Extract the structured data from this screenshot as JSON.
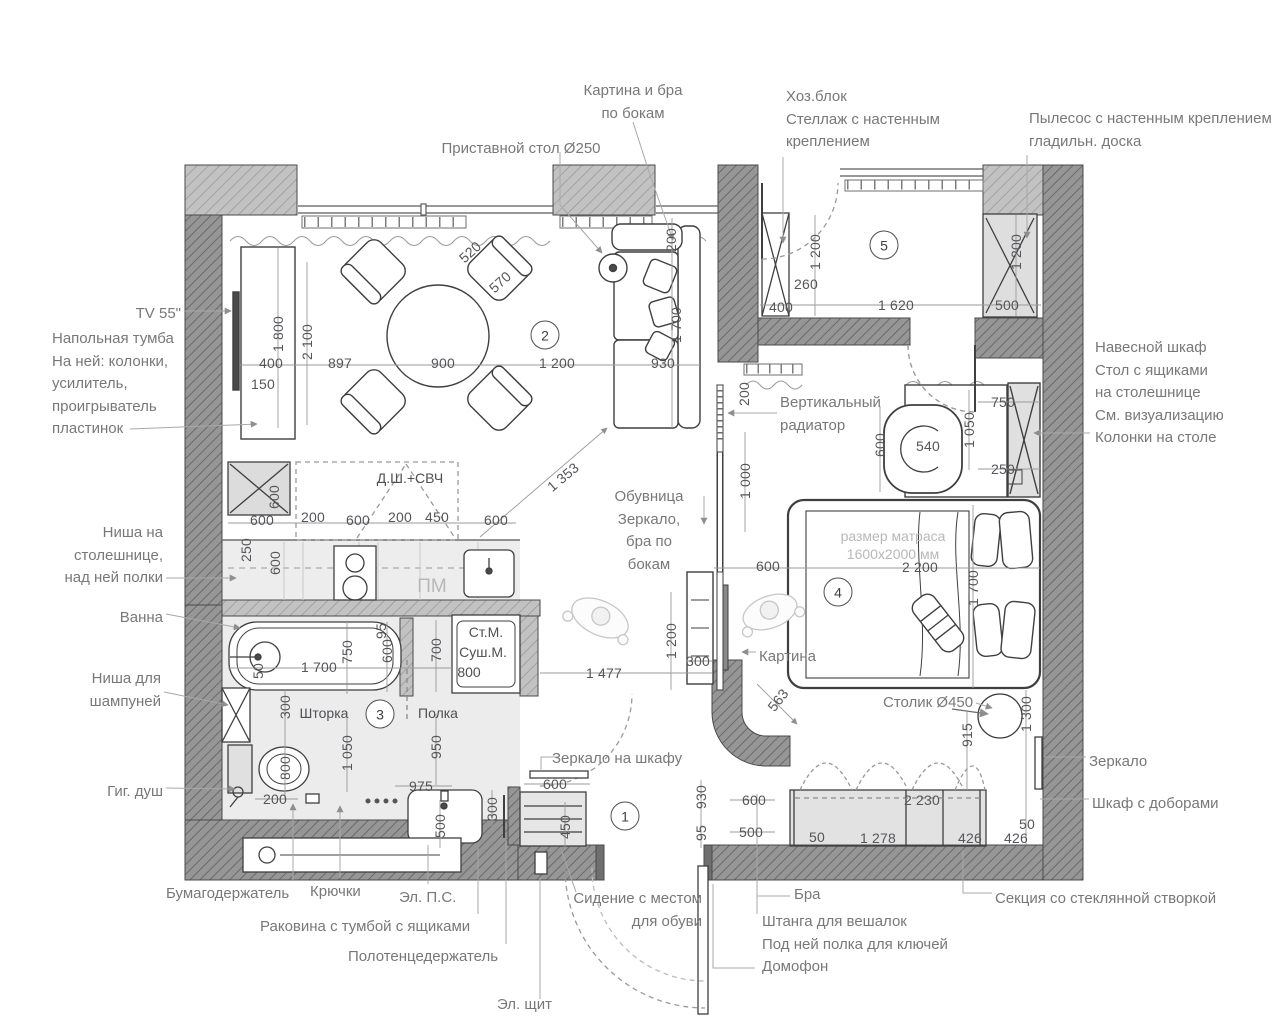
{
  "meta": {
    "doc_type": "apartment interior floor plan",
    "language": "ru"
  },
  "colors": {
    "background": "#ffffff",
    "wall_dark": "#969696",
    "wall_hatch_dark": "#6a6a6a",
    "wall_medium": "#bdbdbd",
    "furniture_line": "#3f3f3f",
    "floor_light": "#ececec",
    "dim_text": "#55555a",
    "annotation_text": "#787878",
    "muted_text": "#b8b8b8"
  },
  "room_markers": [
    {
      "num": "1",
      "x": 625,
      "y": 816
    },
    {
      "num": "2",
      "x": 545,
      "y": 335
    },
    {
      "num": "3",
      "x": 380,
      "y": 714
    },
    {
      "num": "4",
      "x": 838,
      "y": 592
    },
    {
      "num": "5",
      "x": 884,
      "y": 245
    }
  ],
  "annotations": [
    {
      "text": "Картина и бра\nпо бокам",
      "x": 633,
      "y": 80,
      "align": "center"
    },
    {
      "text": "Приставной стол Ø250",
      "x": 521,
      "y": 138,
      "align": "center"
    },
    {
      "text": "Хоз.блок\nСтеллаж с настенным\nкреплением",
      "x": 786,
      "y": 86,
      "align": "left"
    },
    {
      "text": "Пылесос с настенным креплением\nгладильн. доска",
      "x": 1029,
      "y": 108,
      "align": "left"
    },
    {
      "text": "TV 55\"",
      "x": 181,
      "y": 303,
      "align": "right"
    },
    {
      "text": "Напольная тумба\nНа ней: колонки,\nусилитель,\nпроигрыватель\nпластинок",
      "x": 52,
      "y": 328,
      "align": "left"
    },
    {
      "text": "Ниша на\nстолешнице,\nнад ней полки",
      "x": 163,
      "y": 522,
      "align": "right"
    },
    {
      "text": "Ванна",
      "x": 163,
      "y": 607,
      "align": "right"
    },
    {
      "text": "Ниша для\nшампуней",
      "x": 161,
      "y": 668,
      "align": "right"
    },
    {
      "text": "Гиг. душ",
      "x": 163,
      "y": 781,
      "align": "right"
    },
    {
      "text": "Бумагодержатель",
      "x": 166,
      "y": 883,
      "align": "left"
    },
    {
      "text": "Крючки",
      "x": 310,
      "y": 881,
      "align": "left"
    },
    {
      "text": "Эл. П.С.",
      "x": 399,
      "y": 887,
      "align": "left"
    },
    {
      "text": "Раковина с тумбой с ящиками",
      "x": 260,
      "y": 916,
      "align": "left"
    },
    {
      "text": "Полотенцедержатель",
      "x": 348,
      "y": 946,
      "align": "left"
    },
    {
      "text": "Эл. щит",
      "x": 497,
      "y": 994,
      "align": "left"
    },
    {
      "text": "Сидение с местом\nдля обуви",
      "x": 702,
      "y": 888,
      "align": "right"
    },
    {
      "text": "Бра",
      "x": 794,
      "y": 884,
      "align": "left"
    },
    {
      "text": "Штанга для вешалок\nПод ней полка для ключей\nДомофон",
      "x": 762,
      "y": 911,
      "align": "left"
    },
    {
      "text": "Секция со стеклянной створкой",
      "x": 995,
      "y": 888,
      "align": "left"
    },
    {
      "text": "Навесной шкаф\nСтол с ящиками\nна столешнице\nСм. визуализацию\nКолонки на столе",
      "x": 1095,
      "y": 337,
      "align": "left"
    },
    {
      "text": "Зеркало",
      "x": 1089,
      "y": 751,
      "align": "left"
    },
    {
      "text": "Шкаф с доборами",
      "x": 1092,
      "y": 793,
      "align": "left"
    },
    {
      "text": "Вертикальный\nрадиатор",
      "x": 780,
      "y": 392,
      "align": "left"
    },
    {
      "text": "Обувница\nЗеркало,\nбра по\nбокам",
      "x": 649,
      "y": 486,
      "align": "center"
    },
    {
      "text": "Зеркало на шкафу",
      "x": 552,
      "y": 748,
      "align": "left"
    },
    {
      "text": "Картина",
      "x": 759,
      "y": 646,
      "align": "left"
    },
    {
      "text": "Столик Ø450",
      "x": 883,
      "y": 692,
      "align": "left"
    }
  ],
  "plan_texts": [
    {
      "text": "Д.Ш.+СВЧ",
      "x": 410,
      "y": 478
    },
    {
      "text": "ПМ",
      "x": 432,
      "y": 587,
      "muted": true,
      "size": 19
    },
    {
      "text": "Ст.М.",
      "x": 486,
      "y": 632
    },
    {
      "text": "Суш.М.",
      "x": 483,
      "y": 652
    },
    {
      "text": "800",
      "x": 469,
      "y": 672
    },
    {
      "text": "размер матраса",
      "x": 893,
      "y": 536,
      "muted": true
    },
    {
      "text": "1600x2000 мм",
      "x": 893,
      "y": 554,
      "muted": true
    },
    {
      "text": "Шторка",
      "x": 324,
      "y": 713
    },
    {
      "text": "Полка",
      "x": 438,
      "y": 713
    }
  ],
  "dimensions": [
    {
      "t": "520",
      "x": 470,
      "y": 252,
      "r": -42
    },
    {
      "t": "570",
      "x": 500,
      "y": 282,
      "r": -42
    },
    {
      "t": "1 800",
      "x": 278,
      "y": 334,
      "r": -90
    },
    {
      "t": "2 100",
      "x": 307,
      "y": 342,
      "r": -90
    },
    {
      "t": "400",
      "x": 271,
      "y": 363
    },
    {
      "t": "150",
      "x": 263,
      "y": 384
    },
    {
      "t": "897",
      "x": 340,
      "y": 363
    },
    {
      "t": "900",
      "x": 443,
      "y": 363
    },
    {
      "t": "1 200",
      "x": 557,
      "y": 363
    },
    {
      "t": "930",
      "x": 663,
      "y": 363
    },
    {
      "t": "1 700",
      "x": 676,
      "y": 325,
      "r": -90
    },
    {
      "t": "200",
      "x": 671,
      "y": 240,
      "r": -90
    },
    {
      "t": "1 200",
      "x": 815,
      "y": 252,
      "r": -90
    },
    {
      "t": "260",
      "x": 806,
      "y": 284
    },
    {
      "t": "400",
      "x": 781,
      "y": 307
    },
    {
      "t": "1 620",
      "x": 896,
      "y": 305
    },
    {
      "t": "500",
      "x": 1007,
      "y": 305
    },
    {
      "t": "1 200",
      "x": 1016,
      "y": 252,
      "r": -90
    },
    {
      "t": "600",
      "x": 262,
      "y": 520
    },
    {
      "t": "200",
      "x": 313,
      "y": 517
    },
    {
      "t": "600",
      "x": 358,
      "y": 520
    },
    {
      "t": "200",
      "x": 400,
      "y": 517
    },
    {
      "t": "450",
      "x": 437,
      "y": 517
    },
    {
      "t": "600",
      "x": 496,
      "y": 520
    },
    {
      "t": "600",
      "x": 274,
      "y": 497,
      "r": -90
    },
    {
      "t": "250",
      "x": 246,
      "y": 550,
      "r": -90
    },
    {
      "t": "600",
      "x": 275,
      "y": 563,
      "r": -90
    },
    {
      "t": "95",
      "x": 381,
      "y": 631,
      "r": -90
    },
    {
      "t": "750",
      "x": 347,
      "y": 652,
      "r": -90
    },
    {
      "t": "600",
      "x": 387,
      "y": 651,
      "r": -90
    },
    {
      "t": "700",
      "x": 436,
      "y": 650,
      "r": -90
    },
    {
      "t": "1 700",
      "x": 319,
      "y": 667
    },
    {
      "t": "50",
      "x": 258,
      "y": 671,
      "r": -90
    },
    {
      "t": "300",
      "x": 285,
      "y": 707,
      "r": -90
    },
    {
      "t": "800",
      "x": 285,
      "y": 768,
      "r": -90
    },
    {
      "t": "200",
      "x": 275,
      "y": 799
    },
    {
      "t": "1 050",
      "x": 347,
      "y": 753,
      "r": -90
    },
    {
      "t": "950",
      "x": 436,
      "y": 747,
      "r": -90
    },
    {
      "t": "975",
      "x": 421,
      "y": 786
    },
    {
      "t": "500",
      "x": 440,
      "y": 826,
      "r": -90
    },
    {
      "t": "300",
      "x": 492,
      "y": 809,
      "r": -90
    },
    {
      "t": "600",
      "x": 555,
      "y": 784
    },
    {
      "t": "450",
      "x": 565,
      "y": 827,
      "r": -90
    },
    {
      "t": "930",
      "x": 701,
      "y": 797,
      "r": -90
    },
    {
      "t": "95",
      "x": 701,
      "y": 833,
      "r": -90
    },
    {
      "t": "600",
      "x": 754,
      "y": 800
    },
    {
      "t": "500",
      "x": 751,
      "y": 832
    },
    {
      "t": "1 353",
      "x": 563,
      "y": 477,
      "r": -40
    },
    {
      "t": "200",
      "x": 744,
      "y": 394,
      "r": -90
    },
    {
      "t": "600",
      "x": 880,
      "y": 445,
      "r": -90
    },
    {
      "t": "540",
      "x": 928,
      "y": 446
    },
    {
      "t": "750",
      "x": 1003,
      "y": 402
    },
    {
      "t": "1 050",
      "x": 969,
      "y": 430,
      "r": -90
    },
    {
      "t": "250",
      "x": 1003,
      "y": 469
    },
    {
      "t": "1 000",
      "x": 745,
      "y": 481,
      "r": -90
    },
    {
      "t": "600",
      "x": 768,
      "y": 566
    },
    {
      "t": "2 200",
      "x": 920,
      "y": 567
    },
    {
      "t": "1 700",
      "x": 973,
      "y": 588,
      "r": -90
    },
    {
      "t": "1 200",
      "x": 671,
      "y": 641,
      "r": -90
    },
    {
      "t": "300",
      "x": 698,
      "y": 661
    },
    {
      "t": "1 477",
      "x": 604,
      "y": 673
    },
    {
      "t": "563",
      "x": 778,
      "y": 700,
      "r": -52
    },
    {
      "t": "915",
      "x": 967,
      "y": 735,
      "r": -90
    },
    {
      "t": "1 300",
      "x": 1026,
      "y": 714,
      "r": -90
    },
    {
      "t": "2 230",
      "x": 922,
      "y": 800
    },
    {
      "t": "50",
      "x": 1027,
      "y": 824
    },
    {
      "t": "50",
      "x": 817,
      "y": 837
    },
    {
      "t": "1 278",
      "x": 878,
      "y": 838
    },
    {
      "t": "426",
      "x": 970,
      "y": 838
    },
    {
      "t": "426",
      "x": 1016,
      "y": 838
    }
  ]
}
